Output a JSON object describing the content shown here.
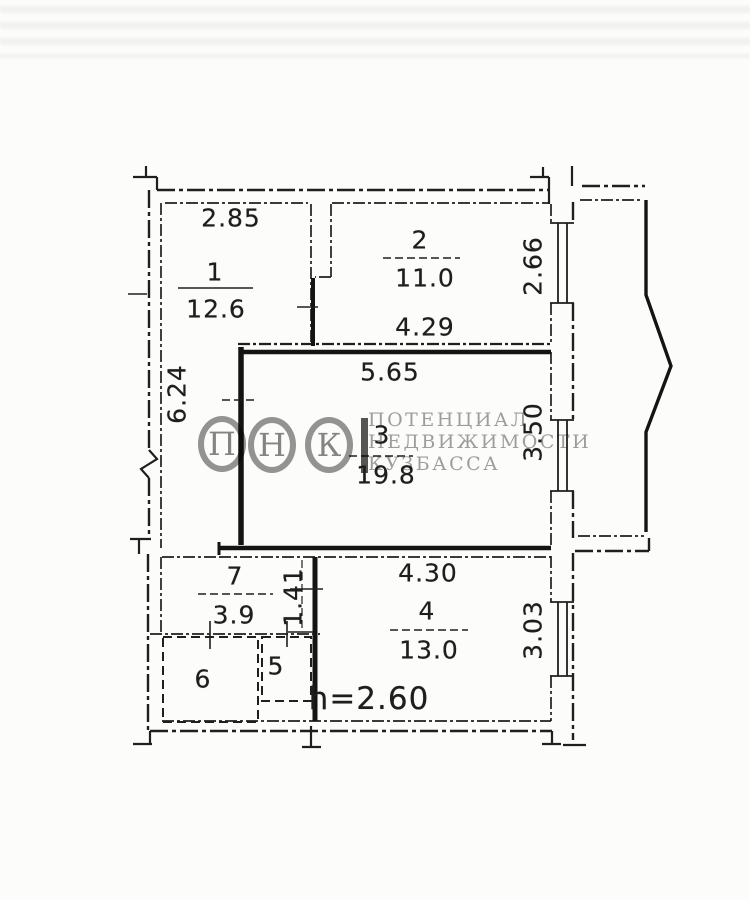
{
  "colors": {
    "ink": "#1f1f1f",
    "watermark_gray": "#9a9a9a",
    "paper": "#fcfcfa"
  },
  "watermark": {
    "monogram": [
      "П",
      "Н",
      "К"
    ],
    "lines": [
      "ПОТЕНЦИАЛ",
      "НЕДВИЖИМОСТИ",
      "КУЗБАССА"
    ]
  },
  "rooms": [
    {
      "number": "1",
      "area": "12.6"
    },
    {
      "number": "2",
      "area": "11.0"
    },
    {
      "number": "3",
      "area": "19.8"
    },
    {
      "number": "4",
      "area": "13.0"
    },
    {
      "number": "5"
    },
    {
      "number": "6"
    },
    {
      "number": "7",
      "area": "3.9"
    }
  ],
  "dimensions": {
    "room1_width": "2.85",
    "left_wall_height": "6.24",
    "room2_width": "4.29",
    "room2_depth": "2.66",
    "room3_width": "5.65",
    "room3_depth": "3.50",
    "hall_opening": "1.41",
    "room4_width": "4.30",
    "room4_depth": "3.03"
  },
  "ceiling_height": "h=2.60"
}
